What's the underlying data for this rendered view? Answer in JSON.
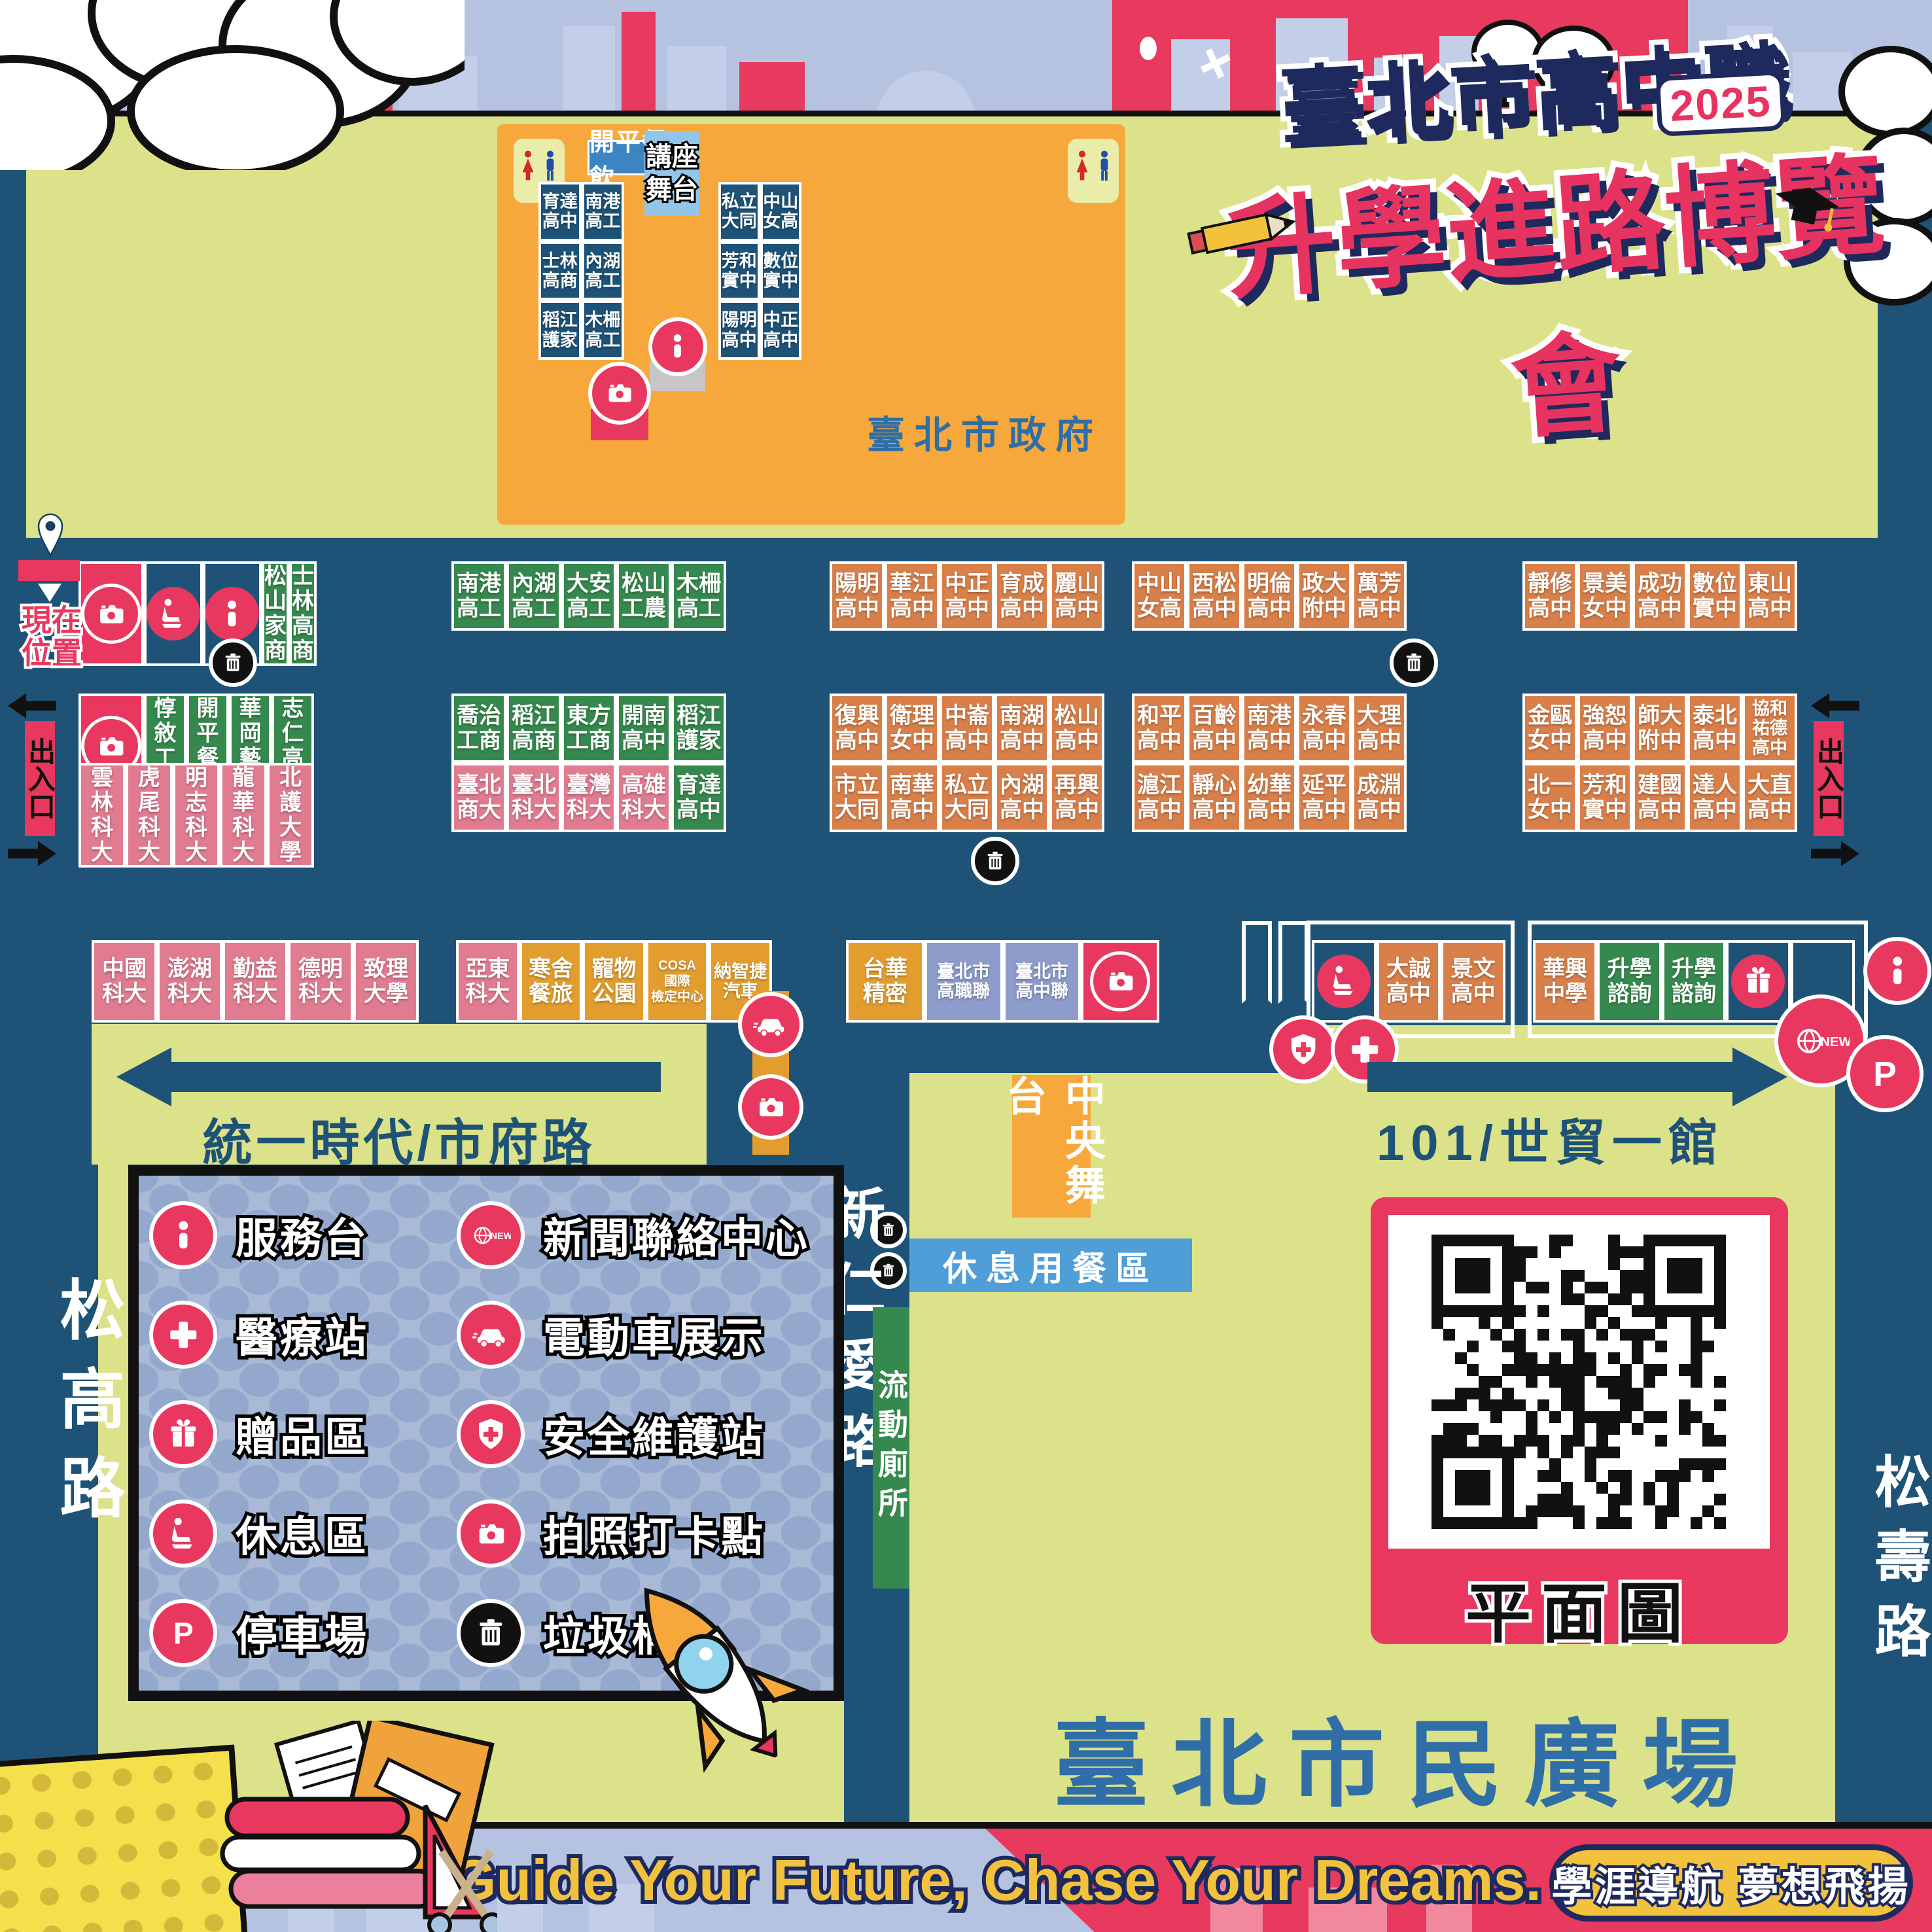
{
  "title": {
    "top": "臺北市高中職",
    "year": "2025",
    "main": "升學進路博覽會"
  },
  "gov": {
    "name": "臺北市政府",
    "food": "開平餐飲",
    "stage": "講座\n舞台"
  },
  "roads": {
    "west": "統一時代/市府路",
    "east": "101/世貿一館",
    "center": "新仁愛路",
    "left": "松高路",
    "right": "松壽路"
  },
  "plaza": {
    "name": "臺北市民廣場",
    "stage": "中央舞台",
    "dining": "休息用餐區",
    "toilet": "流動廁所",
    "qr_label": "平面圖"
  },
  "markers": {
    "current": "現在\n位置",
    "exit": "出入口"
  },
  "banner": {
    "en": "Guide Your Future, Chase Your Dreams.",
    "zh": "學涯導航 夢想飛揚"
  },
  "legend": [
    {
      "icon": "info",
      "label": "服務台"
    },
    {
      "icon": "news",
      "label": "新聞聯絡中心"
    },
    {
      "icon": "cross",
      "label": "醫療站"
    },
    {
      "icon": "car",
      "label": "電動車展示"
    },
    {
      "icon": "gift",
      "label": "贈品區"
    },
    {
      "icon": "shield",
      "label": "安全維護站"
    },
    {
      "icon": "seat",
      "label": "休息區"
    },
    {
      "icon": "camera",
      "label": "拍照打卡點"
    },
    {
      "icon": "parking",
      "label": "停車場"
    },
    {
      "icon": "trash",
      "label": "垃圾桶",
      "dark": true
    }
  ],
  "booths": {
    "govL": [
      {
        "t": "育達\n高中",
        "c": "navy"
      },
      {
        "t": "南港\n高工",
        "c": "navy"
      },
      {
        "t": "士林\n高商",
        "c": "navy"
      },
      {
        "t": "內湖\n高工",
        "c": "navy"
      },
      {
        "t": "稻江\n護家",
        "c": "navy"
      },
      {
        "t": "木柵\n高工",
        "c": "navy"
      }
    ],
    "govR": [
      {
        "t": "私立\n大同",
        "c": "navy"
      },
      {
        "t": "中山\n女高",
        "c": "navy"
      },
      {
        "t": "芳和\n實中",
        "c": "navy"
      },
      {
        "t": "數位\n實中",
        "c": "navy"
      },
      {
        "t": "陽明\n高中",
        "c": "navy"
      },
      {
        "t": "中正\n高中",
        "c": "navy"
      }
    ],
    "r1g1": [
      {
        "icon": "camera",
        "c": "crimson"
      },
      {
        "icon": "seat",
        "c": "navy"
      },
      {
        "icon": "info",
        "c": "navy"
      },
      {
        "t": "松山\n家商",
        "c": "green"
      },
      {
        "t": "士林\n高商",
        "c": "green"
      }
    ],
    "r1g2": [
      {
        "t": "南港\n高工",
        "c": "green"
      },
      {
        "t": "內湖\n高工",
        "c": "green"
      },
      {
        "t": "大安\n高工",
        "c": "green"
      },
      {
        "t": "松山\n工農",
        "c": "green"
      },
      {
        "t": "木柵\n高工",
        "c": "green"
      }
    ],
    "r1g3": [
      {
        "t": "陽明\n高中",
        "c": "orange"
      },
      {
        "t": "華江\n高中",
        "c": "orange"
      },
      {
        "t": "中正\n高中",
        "c": "orange"
      },
      {
        "t": "育成\n高中",
        "c": "orange"
      },
      {
        "t": "麗山\n高中",
        "c": "orange"
      }
    ],
    "r1g4": [
      {
        "t": "中山\n女高",
        "c": "orange"
      },
      {
        "t": "西松\n高中",
        "c": "orange"
      },
      {
        "t": "明倫\n高中",
        "c": "orange"
      },
      {
        "t": "政大\n附中",
        "c": "orange"
      },
      {
        "t": "萬芳\n高中",
        "c": "orange"
      }
    ],
    "r1g5": [
      {
        "t": "靜修\n高中",
        "c": "orange"
      },
      {
        "t": "景美\n女中",
        "c": "orange"
      },
      {
        "t": "成功\n高中",
        "c": "orange"
      },
      {
        "t": "數位\n實中",
        "c": "orange"
      },
      {
        "t": "東山\n高中",
        "c": "orange"
      }
    ],
    "r2g1": [
      {
        "icon": "camera",
        "c": "crimson"
      },
      {
        "t": "惇敘\n工商",
        "c": "green"
      },
      {
        "t": "開平\n餐飲",
        "c": "green"
      },
      {
        "t": "華岡\n藝校",
        "c": "green"
      },
      {
        "t": "志仁\n高中",
        "c": "green"
      }
    ],
    "r3g1": [
      {
        "t": "雲林\n科大",
        "c": "pink"
      },
      {
        "t": "虎尾\n科大",
        "c": "pink"
      },
      {
        "t": "明志\n科大",
        "c": "pink"
      },
      {
        "t": "龍華\n科大",
        "c": "pink"
      },
      {
        "t": "北護\n大學",
        "c": "pink"
      }
    ],
    "r2g2": [
      {
        "t": "喬治\n工商",
        "c": "green"
      },
      {
        "t": "稻江\n高商",
        "c": "green"
      },
      {
        "t": "東方\n工商",
        "c": "green"
      },
      {
        "t": "開南\n高中",
        "c": "green"
      },
      {
        "t": "稻江\n護家",
        "c": "green"
      }
    ],
    "r3g2": [
      {
        "t": "臺北\n商大",
        "c": "pink"
      },
      {
        "t": "臺北\n科大",
        "c": "pink"
      },
      {
        "t": "臺灣\n科大",
        "c": "pink"
      },
      {
        "t": "高雄\n科大",
        "c": "pink"
      },
      {
        "t": "育達\n高中",
        "c": "green"
      }
    ],
    "r2g3": [
      {
        "t": "復興\n高中",
        "c": "orange"
      },
      {
        "t": "衛理\n女中",
        "c": "orange"
      },
      {
        "t": "中崙\n高中",
        "c": "orange"
      },
      {
        "t": "南湖\n高中",
        "c": "orange"
      },
      {
        "t": "松山\n高中",
        "c": "orange"
      }
    ],
    "r3g3": [
      {
        "t": "市立\n大同",
        "c": "orange"
      },
      {
        "t": "南華\n高中",
        "c": "orange"
      },
      {
        "t": "私立\n大同",
        "c": "orange"
      },
      {
        "t": "內湖\n高中",
        "c": "orange"
      },
      {
        "t": "再興\n高中",
        "c": "orange"
      }
    ],
    "r2g4": [
      {
        "t": "和平\n高中",
        "c": "orange"
      },
      {
        "t": "百齡\n高中",
        "c": "orange"
      },
      {
        "t": "南港\n高中",
        "c": "orange"
      },
      {
        "t": "永春\n高中",
        "c": "orange"
      },
      {
        "t": "大理\n高中",
        "c": "orange"
      }
    ],
    "r3g4": [
      {
        "t": "滬江\n高中",
        "c": "orange"
      },
      {
        "t": "靜心\n高中",
        "c": "orange"
      },
      {
        "t": "幼華\n高中",
        "c": "orange"
      },
      {
        "t": "延平\n高中",
        "c": "orange"
      },
      {
        "t": "成淵\n高中",
        "c": "orange"
      }
    ],
    "r2g5": [
      {
        "t": "金甌\n女中",
        "c": "orange"
      },
      {
        "t": "強恕\n高中",
        "c": "orange"
      },
      {
        "t": "師大\n附中",
        "c": "orange"
      },
      {
        "t": "泰北\n高中",
        "c": "orange"
      },
      {
        "t": "協和\n祐德\n高中",
        "c": "orange",
        "s": 2
      }
    ],
    "r3g5": [
      {
        "t": "北一\n女中",
        "c": "orange"
      },
      {
        "t": "芳和\n實中",
        "c": "orange"
      },
      {
        "t": "建國\n高中",
        "c": "orange"
      },
      {
        "t": "達人\n高中",
        "c": "orange"
      },
      {
        "t": "大直\n高中",
        "c": "orange"
      }
    ],
    "r4g1": [
      {
        "t": "中國\n科大",
        "c": "pink"
      },
      {
        "t": "澎湖\n科大",
        "c": "pink"
      },
      {
        "t": "勤益\n科大",
        "c": "pink"
      },
      {
        "t": "德明\n科大",
        "c": "pink"
      },
      {
        "t": "致理\n大學",
        "c": "pink"
      }
    ],
    "r4g2": [
      {
        "t": "亞東\n科大",
        "c": "pink"
      },
      {
        "t": "寒舍\n餐旅",
        "c": "gold"
      },
      {
        "t": "寵物\n公園",
        "c": "gold"
      },
      {
        "t": "COSA\n國際\n檢定中心",
        "c": "gold",
        "s": 3
      },
      {
        "t": "納智捷\n汽車",
        "c": "gold",
        "s": 2
      }
    ],
    "r4g3": [
      {
        "t": "台華\n精密",
        "c": "gold"
      },
      {
        "t": "臺北市\n高職聯",
        "c": "lav",
        "s": 2
      },
      {
        "t": "臺北市\n高中聯",
        "c": "lav",
        "s": 2
      },
      {
        "icon": "camera",
        "c": "crimson"
      }
    ],
    "r4g4": [
      {
        "icon": "seat",
        "c": "navy"
      },
      {
        "t": "大誠\n高中",
        "c": "orange"
      },
      {
        "t": "景文\n高中",
        "c": "orange"
      }
    ],
    "r4g5": [
      {
        "t": "華興\n中學",
        "c": "orange"
      },
      {
        "t": "升學\n諮詢",
        "c": "green"
      },
      {
        "t": "升學\n諮詢",
        "c": "green"
      },
      {
        "icon": "gift",
        "c": "navy"
      },
      {
        "t": "",
        "c": "blank"
      }
    ]
  },
  "colors": {
    "bg": "#1E5377",
    "green_area": "#DCE289",
    "booth_orange": "#D87F4A",
    "booth_green": "#36894E",
    "booth_pink": "#E07B90",
    "crimson": "#E8385F",
    "gold": "#E29D2E",
    "lavender": "#8D9CCA",
    "label_blue": "#3D85C2",
    "stage_blue": "#93C5E9",
    "dining_blue": "#4F9ED8",
    "legend_bg": "#A9BAD6",
    "title_navy": "#1E2A5E",
    "title_pink": "#E6335F",
    "gov_text": "#2F6EA6",
    "banner_yellow": "#F2C23E"
  }
}
